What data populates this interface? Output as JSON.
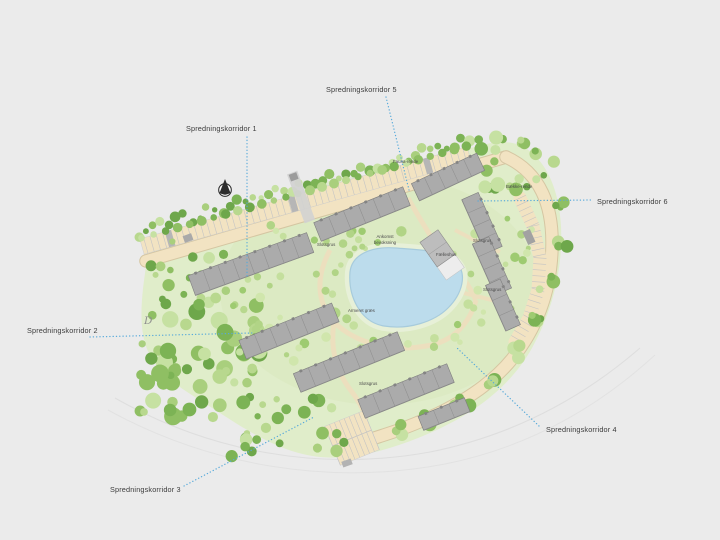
{
  "site_plan": {
    "corridors": [
      {
        "label": "Spredningskorridor 1"
      },
      {
        "label": "Spredningskorridor 2"
      },
      {
        "label": "Spredningskorridor 3"
      },
      {
        "label": "Spredningskorridor 4"
      },
      {
        "label": "Spredningskorridor 5"
      },
      {
        "label": "Spredningskorridor 6"
      }
    ],
    "features": {
      "fauna_channel": "Fauna-rende",
      "stream_channel": "Bække-rende",
      "arrival_line1": "Ankomst",
      "arrival_line2": "bevoksning",
      "common_house": "Fælleshus",
      "gravel_label": "Slotsgrus",
      "reinforced_grass": "Armeret græs",
      "map_letter": "D"
    },
    "icons": {
      "north_arrow": "north-arrow-icon"
    },
    "colors": {
      "background": "#ebebeb",
      "meadow": "#e0edca",
      "inner_meadow": "#d8e8bd",
      "road": "#f2e3c2",
      "road_edge": "#d5c6a2",
      "parking_tick": "#c4c4c4",
      "building": "#ababab",
      "building_line": "#8d8d8d",
      "building_stroke": "#7e7e7e",
      "dormer": "#848484",
      "pond": "#bcdcec",
      "pond_edge": "#a7cbdc",
      "pond_halo": "#e7f0d8",
      "corridor_line": "#58aada",
      "tree_greens_full": [
        "#a9cf7d",
        "#8fbf63",
        "#7cb355",
        "#b8d88e",
        "#6ea74b",
        "#c6e1a2"
      ],
      "tree_greens_light": [
        "#c4df9d",
        "#b1d486",
        "#9ecb71",
        "#d0e6ac"
      ]
    }
  }
}
